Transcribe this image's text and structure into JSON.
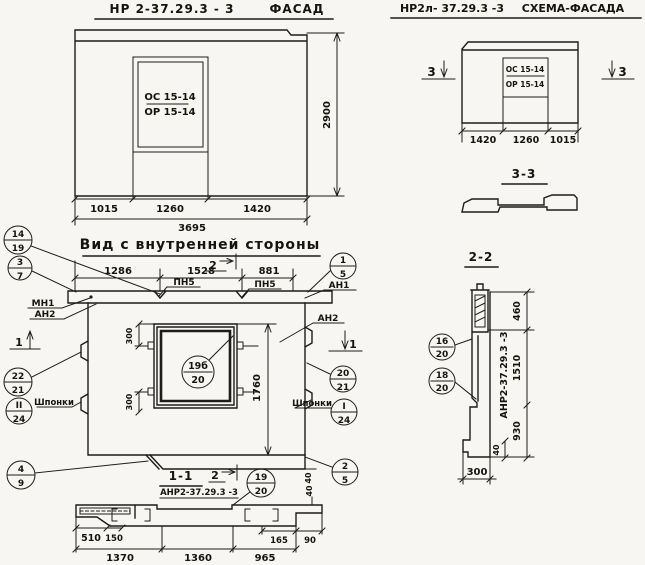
{
  "facade": {
    "title_code": "НР 2-37.29.3 - 3",
    "title_word": "ФАСАД",
    "window": {
      "top": "ОС 15-14",
      "bottom": "ОР 15-14"
    },
    "dim_1015": "1015",
    "dim_1260": "1260",
    "dim_1420": "1420",
    "dim_total": "3695",
    "dim_height": "2900"
  },
  "schema": {
    "title_code": "НР2л- 37.29.3 -3",
    "title_word": "СХЕМА-ФАСАДА",
    "window": {
      "top": "ОС 15-14",
      "bottom": "ОР 15-14"
    },
    "dim_1420": "1420",
    "dim_1260": "1260",
    "dim_1015": "1015",
    "mark_left": "3",
    "mark_right": "3"
  },
  "section33": {
    "title": "3-3"
  },
  "section22": {
    "title": "2-2",
    "panel_mark": "АНР2-37.29.3 -3",
    "dim_460": "460",
    "dim_1510": "1510",
    "dim_930": "930",
    "dim_40": "40",
    "dim_300": "300",
    "callout_16_20": {
      "top": "16",
      "bottom": "20"
    },
    "callout_18_20": {
      "top": "18",
      "bottom": "20"
    }
  },
  "inner": {
    "title": "Вид с внутренней стороны",
    "dim_1286": "1286",
    "dim_1528": "1528",
    "dim_881": "881",
    "pn5_left": "ПН5",
    "pn5_right": "ПН5",
    "dim_300_top": "300",
    "dim_300_bottom": "300",
    "dim_1760": "1760",
    "dim_40": "40",
    "label_mn1": "МН1",
    "label_an2_left": "АН2",
    "label_an1": "АН1",
    "label_an2_right": "АН2",
    "label_shponki_left": "Шпонки",
    "label_shponki_right": "Шпонки",
    "mark_1_left": "1",
    "mark_1_right": "1",
    "mark_2_top": "2",
    "callout_14_19": {
      "top": "14",
      "bottom": "19"
    },
    "callout_3_7": {
      "top": "3",
      "bottom": "7"
    },
    "callout_22_21": {
      "top": "22",
      "bottom": "21"
    },
    "callout_ii_24": {
      "top": "II",
      "bottom": "24"
    },
    "callout_4_9": {
      "top": "4",
      "bottom": "9"
    },
    "callout_1_5": {
      "top": "1",
      "bottom": "5"
    },
    "callout_20_21": {
      "top": "20",
      "bottom": "21"
    },
    "callout_i_24": {
      "top": "I",
      "bottom": "24"
    },
    "callout_2_5": {
      "top": "2",
      "bottom": "5"
    },
    "callout_19b_20": {
      "top": "19б",
      "bottom": "20"
    }
  },
  "section11": {
    "title": "1-1",
    "mark_2": "2",
    "subtitle": "АНР2-37.29.3 -3",
    "callout_19_20": {
      "top": "19",
      "bottom": "20"
    },
    "dim_510": "510",
    "dim_150": "150",
    "dim_1370": "1370",
    "dim_1360": "1360",
    "dim_965": "965",
    "dim_165": "165",
    "dim_90": "90",
    "dim_40": "40"
  }
}
